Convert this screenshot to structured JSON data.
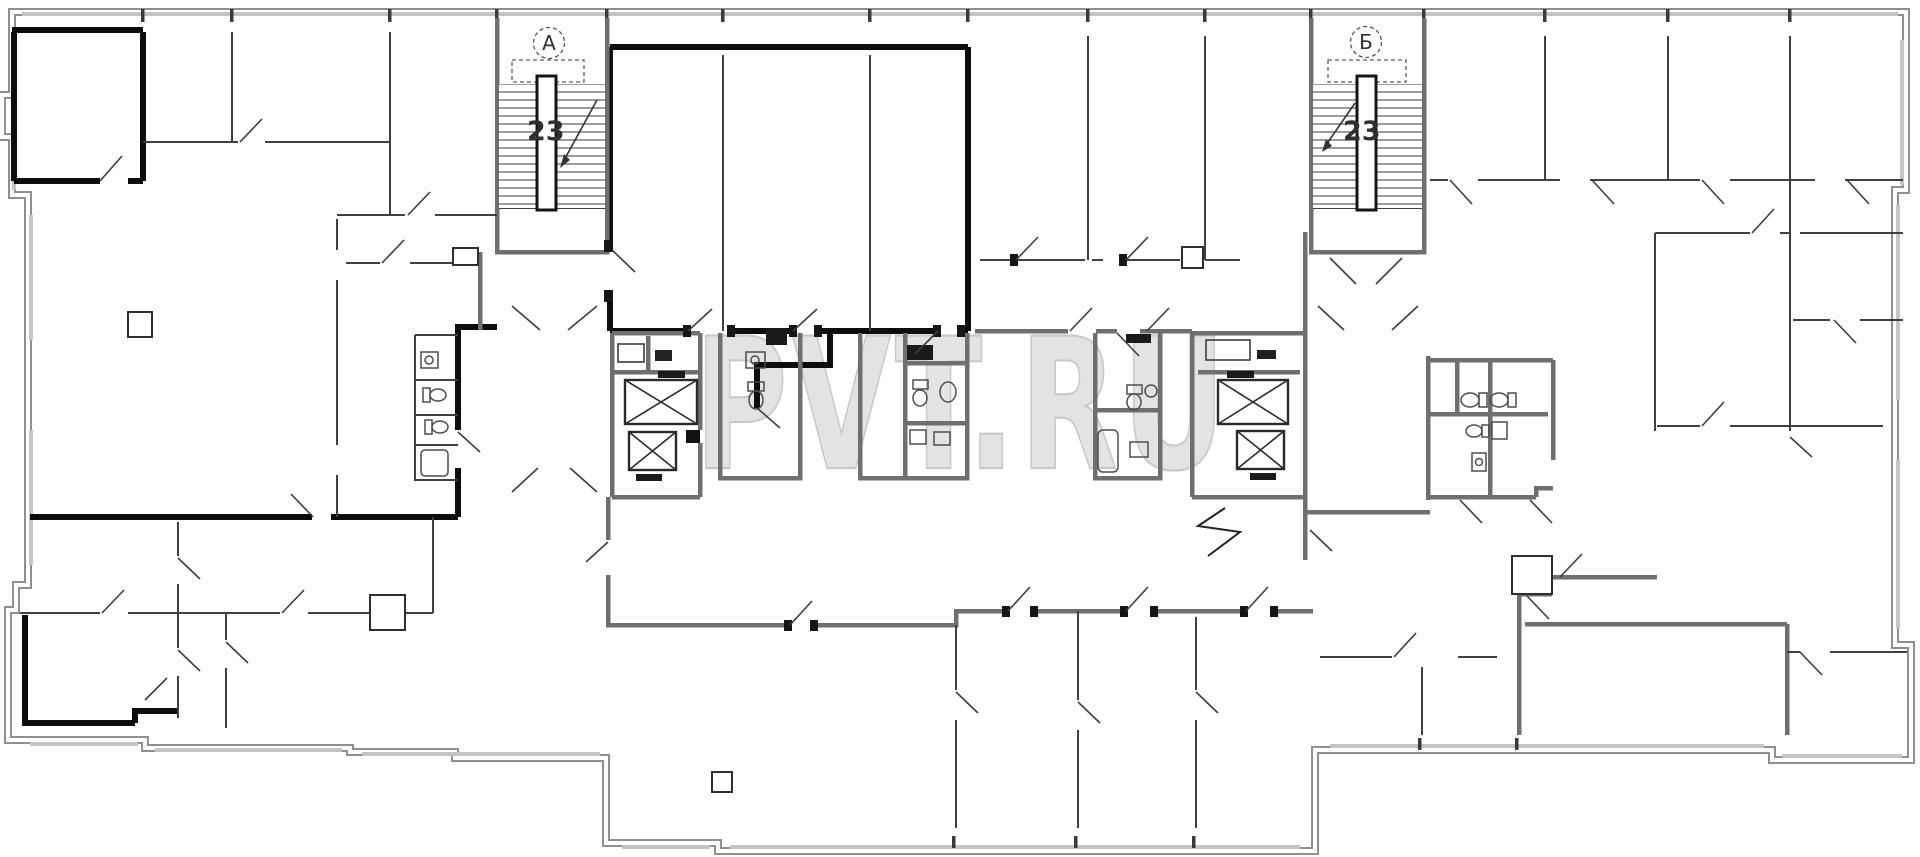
{
  "document": {
    "type": "scanned architectural floor plan",
    "background": "#ffffff"
  },
  "watermark": {
    "text": "PVT.RU",
    "fill": "#e3e3e3",
    "outline": "#c9c9c9"
  },
  "labels": {
    "stairwell_a": {
      "label": "А",
      "floor_count": "23"
    },
    "stairwell_b": {
      "label": "Б",
      "floor_count": "23"
    }
  },
  "colors": {
    "wall_bold": "#0d0d0d",
    "wall_structural": "#6f6f6f",
    "wall_exterior": "#8f8f8f",
    "wall_partition": "#404040",
    "window_band": "#c4c4c4",
    "fixture": "#4d4d4d",
    "label_text": "#2f2f2f"
  }
}
